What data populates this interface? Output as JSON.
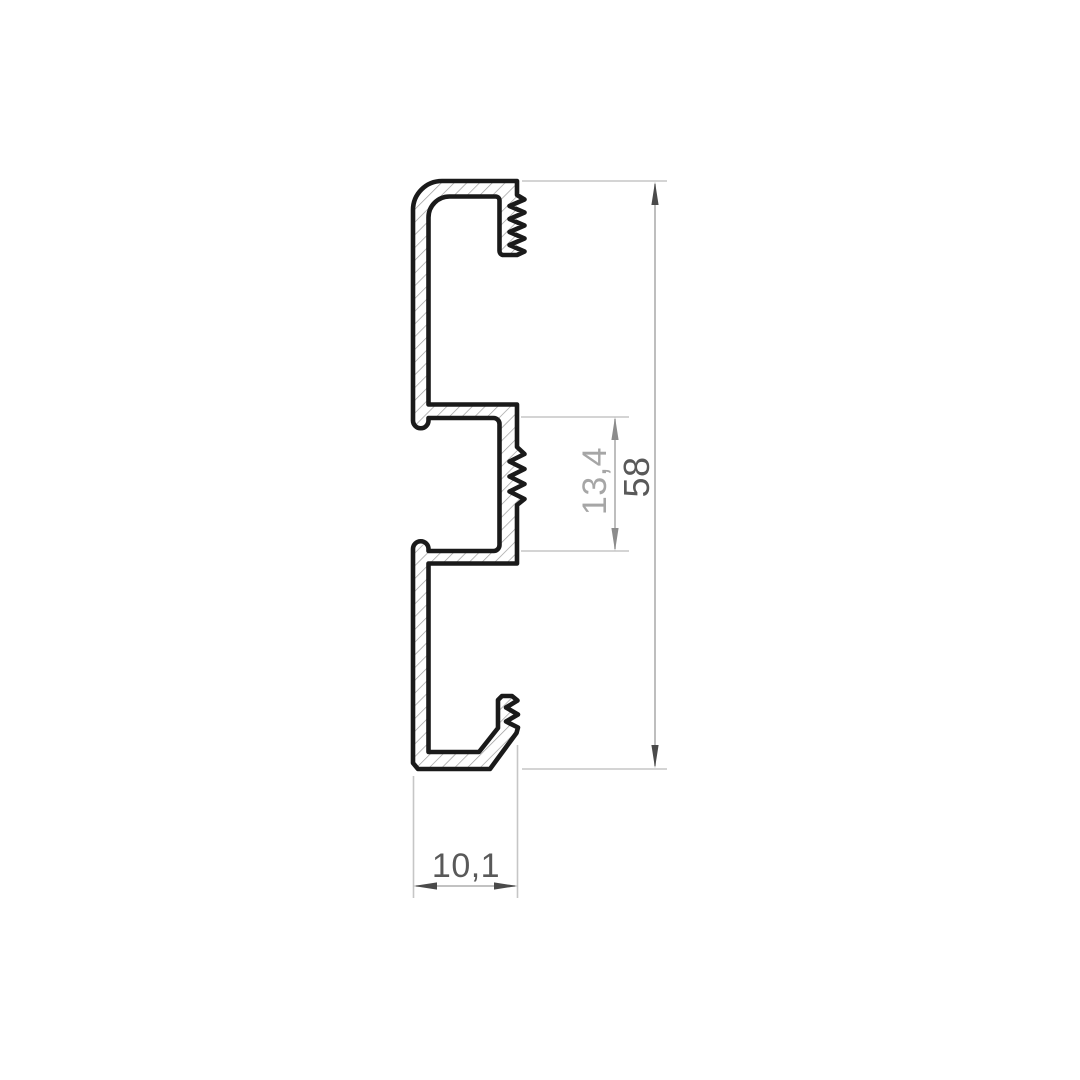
{
  "drawing": {
    "kind": "profile-cross-section-technical-drawing",
    "subject": "extruded aluminium profile cross section with serrated tongues",
    "background_color": "#ffffff",
    "outline_color": "#1a1a1a",
    "hatch_color": "#9b9b9b",
    "extension_line_color": "#c6c6c6",
    "dimension_line_color": "#aeaeae",
    "dimensions": {
      "overall_height": {
        "label": "58",
        "orientation": "vertical",
        "text_color": "#595959",
        "arrow_color": "#4a4a4a"
      },
      "slot_height": {
        "label": "13,4",
        "orientation": "vertical",
        "text_color": "#a6a6a6",
        "arrow_color": "#8c8c8c"
      },
      "overall_depth": {
        "label": "10,1",
        "orientation": "horizontal",
        "text_color": "#595959",
        "arrow_color": "#4a4a4a"
      }
    }
  }
}
